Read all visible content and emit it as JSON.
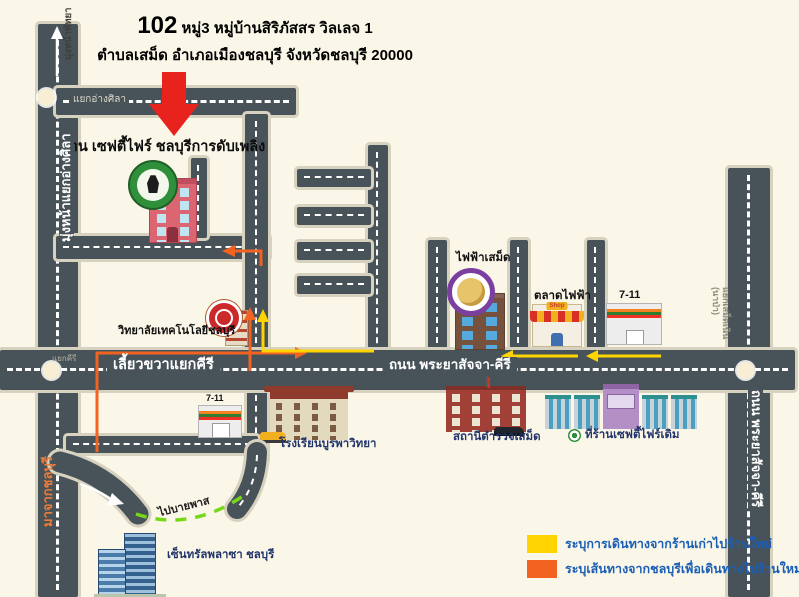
{
  "title": {
    "number": "102",
    "line1": "หมู่3 หมู่บ้านสิริภัสสร วิลเลจ 1",
    "line2": "ตำบลเสม็ด อำเภอเมืองชลบุรี จังหวัดชลบุรี 20000"
  },
  "map": {
    "new_shop_label": "ร้าน เซฟตี้ไฟร์ ชลบุรีการดับเพลิง",
    "junction_angsila": "แยกอ่างศิลา",
    "toward_pattaya": "มุ่งหน้าพัทยา",
    "toward_angsila": "มุ่งหน้าแยกอ่างศิลา",
    "from_chonburi": "มาจากชลบุรี",
    "turn_right_kiri": "เลี้ยวขวาแยกคีรี",
    "junction_kiri": "แยกคีรี",
    "main_road_name": "ถนน พระยาสัจจา-คีรี",
    "right_road_name": "ถนน พระยาสัจจา-คีรี",
    "right_junction_line1": "แยกเสม็ดเนิน",
    "right_junction_line2": "(นาป่า)",
    "to_bypass": "ไปบายพาส",
    "college": "วิทยาลัยเทคโนโลยีชลบุรี",
    "electricity_office": "ไฟฟ้าเสม็ด",
    "electricity_market": "ตลาดไฟฟ้า",
    "market_sign": "Shop",
    "seven_eleven_top": "7-11",
    "seven_eleven_left": "7-11",
    "school": "โรงเรียนบูรพาวิทยา",
    "police_station": "สถานีตำรวจเสม็ด",
    "old_shop": "ที่ร้านเซฟตี้ไฟร์เดิม",
    "central_plaza": "เซ็นทรัลพลาซา ชลบุรี"
  },
  "legend": {
    "items": [
      {
        "color": "#ffd400",
        "label": "ระบุการเดินทางจากร้านเก่าไปร้านใหม่"
      },
      {
        "color": "#f26322",
        "label": "ระบุเส้นทางจากชลบุรีเพื่อเดินทางไปร้านใหม่"
      }
    ]
  },
  "colors": {
    "background": "#fbf7e8",
    "road": "#475359",
    "route_old_to_new": "#ffd400",
    "route_from_chonburi": "#f26322",
    "bypass_path_green": "#76d816",
    "marker_arrow_red": "#e8231d"
  }
}
